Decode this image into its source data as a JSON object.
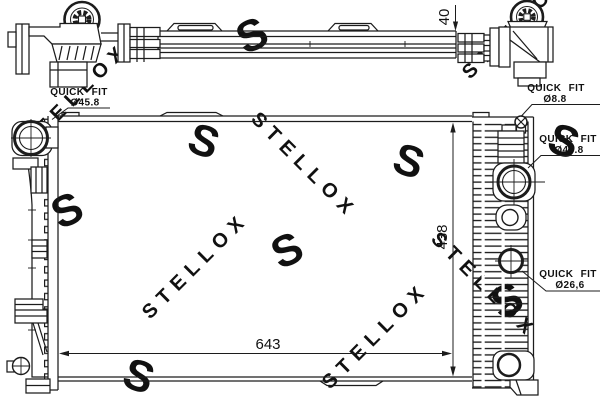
{
  "drawing": {
    "title": "radiator-technical-drawing",
    "background": "#ffffff",
    "line_color": "#1c1c1c",
    "watermark_color_letter": "#e9e9e9",
    "watermark_color_word": "#f0f0f0"
  },
  "watermark": {
    "letter": "S",
    "word": "STELLOX"
  },
  "dimensions": {
    "core_depth": "40",
    "core_width": "643",
    "core_height": "438"
  },
  "quick_fit_labels": {
    "top_left": {
      "title": "QUICK FIT",
      "size": "Ø45.8"
    },
    "top_right": {
      "title": "QUICK FIT",
      "size": "Ø8.8"
    },
    "right_upper": {
      "title": "QUICK FIT",
      "size": "Ø45.8"
    },
    "right_lower": {
      "title": "QUICK FIT",
      "size": "Ø26,6"
    }
  }
}
